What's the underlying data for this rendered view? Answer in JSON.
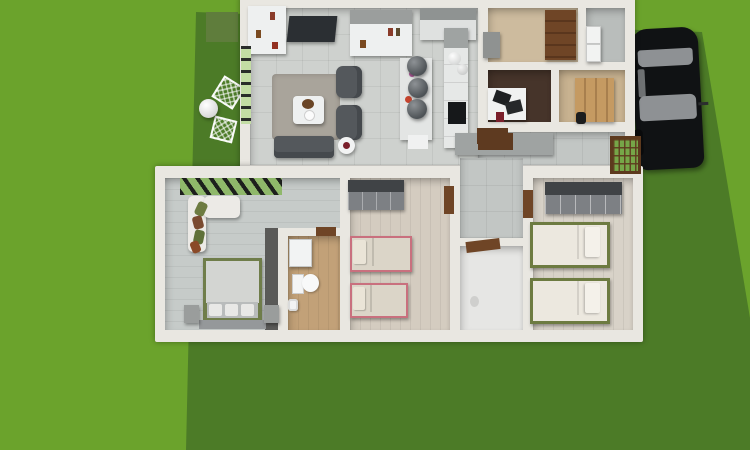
{
  "scene": {
    "description": "Top-down 3D render of a single-story house floor plan sitting on a two-tone green lawn, with a black sedan parked to the right and white garden furniture on a dark lawn strip to the left.",
    "view": "aerial 3d floor plan"
  },
  "palette": {
    "grass-light": "#6ba32c",
    "grass-dark": "#4c7b27",
    "patch-olive": "#5f7d3c",
    "wall": "#e9e7e1",
    "tile": "#ced1ce",
    "hall": "#c2c6c4",
    "plank-gray": "#c6cbc9",
    "plank-beige": "#d4ccc0",
    "plank-light": "#d8d2c8",
    "wood-bath": "#c2a178",
    "marble": "#e6e6e4",
    "office-floor": "#46342a",
    "entry-floor": "#cdbb9e",
    "closet-floor": "#c8b290",
    "utility-floor": "#b9bdbb",
    "sofa-dark": "#54585c",
    "rug": "#a9a49b",
    "white-furn": "#eef0f0",
    "counter-gray": "#9fa3a2",
    "wardrobe-top": "#404346",
    "wardrobe-front": "#7d8084",
    "bed-pink": "#c9707e",
    "bed-olive": "#6d7b41",
    "bedding-beige": "#dbd5c8",
    "bedding-white": "#ece8df",
    "door-brown": "#6f4526",
    "window-green": "#76a648",
    "shutter-green": "#c3dda4",
    "car-black": "#101214",
    "car-glass": "#8e9194"
  },
  "exterior": {
    "ground": "light green grass",
    "lawn_patch": "dark green lawn band running from the left of the house to the bottom-right of the yard",
    "garden": {
      "chairs": [
        "white lattice garden chair",
        "white lattice garden chair"
      ],
      "globe_light": "white sphere lamp"
    },
    "car": {
      "type": "black sedan, parked facing up, right of house",
      "windows": "gray windshield and rear window"
    }
  },
  "house": {
    "rooms": [
      {
        "id": "living-room",
        "name": "living room",
        "floor": "light gray tile",
        "furniture": [
          "wall shelf with books",
          "wall-mounted tv",
          "wall cabinet with books",
          "green shuttered windows",
          "area rug",
          "coffee table with plant",
          "armchair",
          "armchair",
          "sofa",
          "round side table"
        ]
      },
      {
        "id": "kitchen",
        "name": "open kitchen",
        "floor": "light gray tile",
        "furniture": [
          "top cabinets",
          "island with three dark pendant balls and flowers",
          "tall counter with black cooktop",
          "bottom counter with brown doormat",
          "white decor vases"
        ]
      },
      {
        "id": "entry-room",
        "name": "entry / pantry",
        "floor": "beige wood",
        "furniture": [
          "brown wardrobe",
          "gray cabinet"
        ]
      },
      {
        "id": "utility-room",
        "name": "utility room",
        "floor": "gray",
        "furniture": [
          "white appliance",
          "white appliance"
        ]
      },
      {
        "id": "office",
        "name": "office",
        "floor": "dark brown wood",
        "furniture": [
          "white desk",
          "black chair",
          "black chair",
          "red stool"
        ]
      },
      {
        "id": "walk-in-closet",
        "name": "walk-in closet",
        "floor": "tan wood",
        "furniture": [
          "wooden cabinet wall",
          "dark bag"
        ]
      },
      {
        "id": "hallway",
        "name": "hallway",
        "floor": "gray tile",
        "furniture": [
          "green-paned window",
          "brown doormat",
          "brown interior doors"
        ]
      },
      {
        "id": "master-bedroom",
        "name": "master bedroom",
        "floor": "gray wood planks",
        "furniture": [
          "slatted window",
          "white corner sofa with green and brown cushions",
          "double bed with olive frame and gray duvet",
          "nightstand",
          "nightstand",
          "tall dark cabinet"
        ]
      },
      {
        "id": "bathroom-1",
        "name": "bathroom",
        "floor": "light brown wood",
        "furniture": [
          "sink cabinet",
          "toilet",
          "bidet",
          "brown door"
        ]
      },
      {
        "id": "kids-bedroom",
        "name": "bedroom with pink beds",
        "floor": "beige planks",
        "furniture": [
          "gray wardrobe",
          "single bed with pink frame",
          "single bed with pink frame",
          "brown door"
        ]
      },
      {
        "id": "shower-room",
        "name": "shower room",
        "floor": "white marble",
        "furniture": [
          "brown door"
        ]
      },
      {
        "id": "twin-bedroom",
        "name": "bedroom with twin beds",
        "floor": "light beige planks",
        "furniture": [
          "gray wardrobe",
          "single bed with olive frame",
          "single bed with olive frame"
        ]
      }
    ]
  }
}
